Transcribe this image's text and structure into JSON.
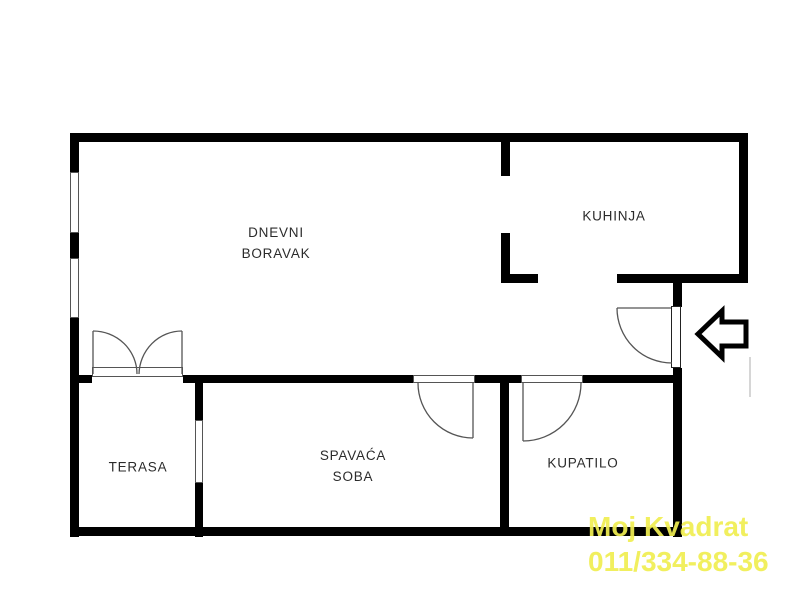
{
  "rooms": [
    {
      "id": "dnevni-boravak",
      "name": "DNEVNI\nBORAVAK"
    },
    {
      "id": "kuhinja",
      "name": "KUHINJA"
    },
    {
      "id": "terasa",
      "name": "TERASA"
    },
    {
      "id": "spavaca-soba",
      "name": "SPAVAĆA\nSOBA"
    },
    {
      "id": "kupatilo",
      "name": "KUPATILO"
    }
  ],
  "watermark": {
    "line1": "Moj Kvadrat",
    "line2": "011/334-88-36"
  },
  "icons": {
    "entrance_arrow": "block-arrow-left"
  },
  "colors": {
    "wall": "#000000",
    "background": "#ffffff",
    "label_text": "#2b2b2b",
    "thin_line": "#555555",
    "watermark": "#f0ee52"
  }
}
